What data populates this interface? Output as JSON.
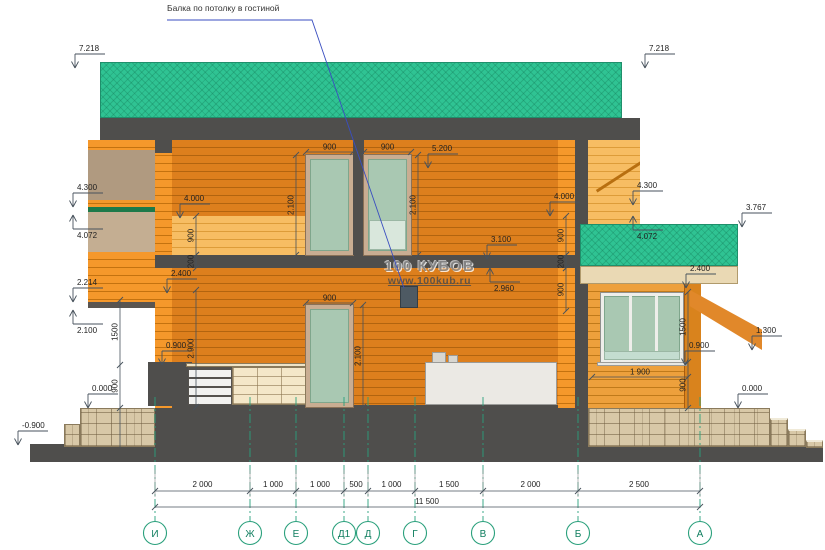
{
  "drawing": {
    "leader_label": "Балка по потолку в гостиной",
    "watermark": {
      "brand": "100 КУБОВ",
      "url": "www.100kub.ru"
    }
  },
  "elevations": {
    "roof_left": "7.218",
    "roof_right": "7.218",
    "left_4300": "4.300",
    "left_4072": "4.072",
    "left_2214": "2.214",
    "left_2100": "2.100",
    "left_0000": "0.000",
    "left_minus0900": "-0.900",
    "ceiling_2f_5200": "5.200",
    "left_4000": "4.000",
    "right_4000": "4.000",
    "slab_3100": "3.100",
    "ceiling_1f_2960": "2.960",
    "left_2400": "2.400",
    "annex_2400": "2.400",
    "annex_3767": "3.767",
    "right_4300": "4.300",
    "right_4072": "4.072",
    "right_1300": "1.300",
    "annex_0900": "0.900",
    "right_0000": "0.000",
    "kitchen_0900": "0.900"
  },
  "dims": {
    "door1_2f_width": "900",
    "door2_2f_width": "900",
    "door1_2f_height": "2.100",
    "door2_2f_height": "2.100",
    "parapet_left_900": "900",
    "slab_left_200": "200",
    "parapet_right_900": "900",
    "slab_right_200": "200",
    "below_slab_right_900": "900",
    "door_1f_width": "900",
    "door_1f_height": "2.100",
    "room_height_2900": "2.900",
    "bay_1500": "1500",
    "bay_900": "900",
    "annex_window_1500": "1500",
    "annex_sill_900": "900",
    "annex_width_1900": "1 900"
  },
  "axes": {
    "letters": [
      "И",
      "Ж",
      "Е",
      "Д1",
      "Д",
      "Г",
      "В",
      "Б",
      "А"
    ],
    "segments": [
      "2 000",
      "1 000",
      "1 000",
      "500",
      "1 000",
      "1 500",
      "2 000",
      "2 500"
    ],
    "total": "11 500"
  },
  "colors": {
    "roof_green": "#2fc393",
    "timber_cut": "#f5982b",
    "timber_far": "#dd7f1d",
    "timber_light": "#f7bd63",
    "slab_dark": "#4f4e4c",
    "stone": "#d8c8a7",
    "glass": "#a9c8b2",
    "axis_teal": "#2aa07c",
    "dim_line": "#47525c",
    "leader_blue": "#3a4ec0"
  }
}
